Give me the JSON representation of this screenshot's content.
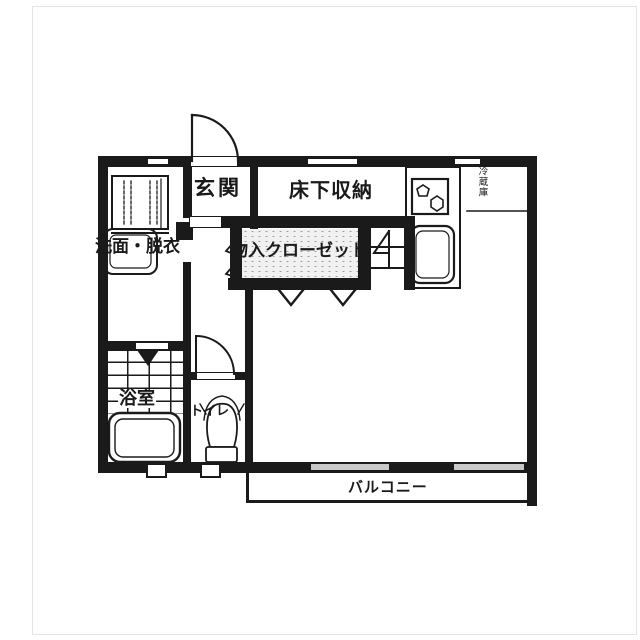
{
  "document": {
    "type": "apartment-floor-plan"
  },
  "labels": {
    "entrance": "玄関",
    "underfloor_storage": "床下収納",
    "washroom": "洗面・脱衣",
    "closet": "物入クローゼット",
    "bathroom": "浴室",
    "toilet": "トイレ",
    "balcony": "バルコニー",
    "refrigerator": "冷蔵庫"
  },
  "colors": {
    "wall": "#1a1a1a",
    "background": "#ffffff",
    "closet_shade": "#f1f1f1",
    "window_slide": "#c9c9c9"
  }
}
